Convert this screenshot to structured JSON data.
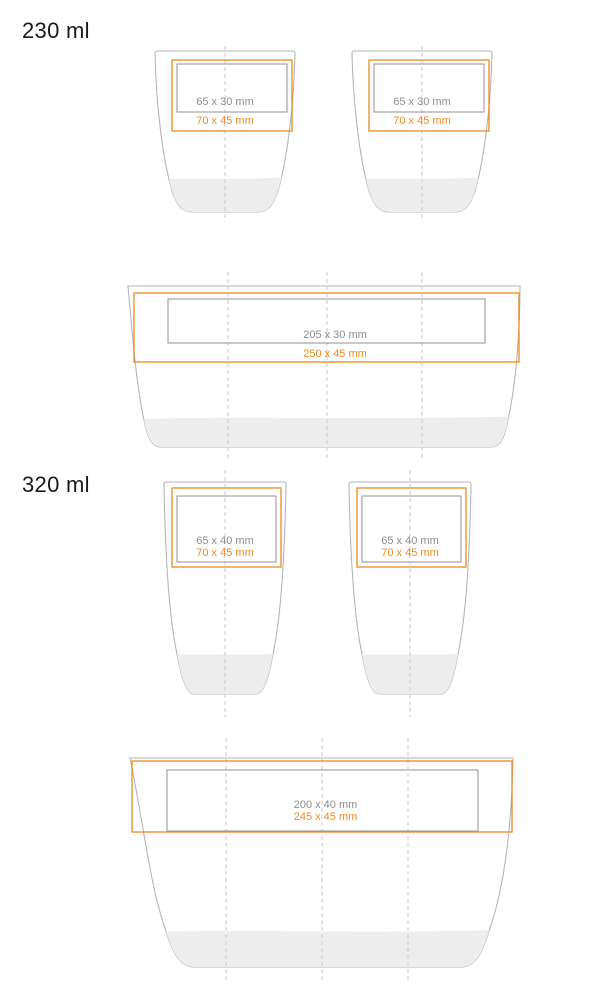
{
  "colors": {
    "orange": "#EF8A1E",
    "cup_outline": "#B5B5B5",
    "area_gray": "#9B9B9B",
    "text_gray": "#8C8C8C",
    "fill_gray": "#EDEDED",
    "dash_gray": "#C9C9C9",
    "heading_dark": "#1A1A1A",
    "background": "#FFFFFF"
  },
  "sections": [
    {
      "volume_label": "230 ml",
      "front_views": [
        {
          "print_area": "65 x 30 mm",
          "max_area": "70 x 45 mm"
        },
        {
          "print_area": "65 x 30 mm",
          "max_area": "70 x 45 mm"
        }
      ],
      "wrap_view": {
        "print_area": "205 x 30 mm",
        "max_area": "250 x 45 mm"
      }
    },
    {
      "volume_label": "320 ml",
      "front_views": [
        {
          "print_area": "65 x 40 mm",
          "max_area": "70 x 45 mm"
        },
        {
          "print_area": "65 x 40 mm",
          "max_area": "70 x 45 mm"
        }
      ],
      "wrap_view": {
        "print_area": "200 x 40 mm",
        "max_area": "245 x 45 mm"
      }
    }
  ]
}
